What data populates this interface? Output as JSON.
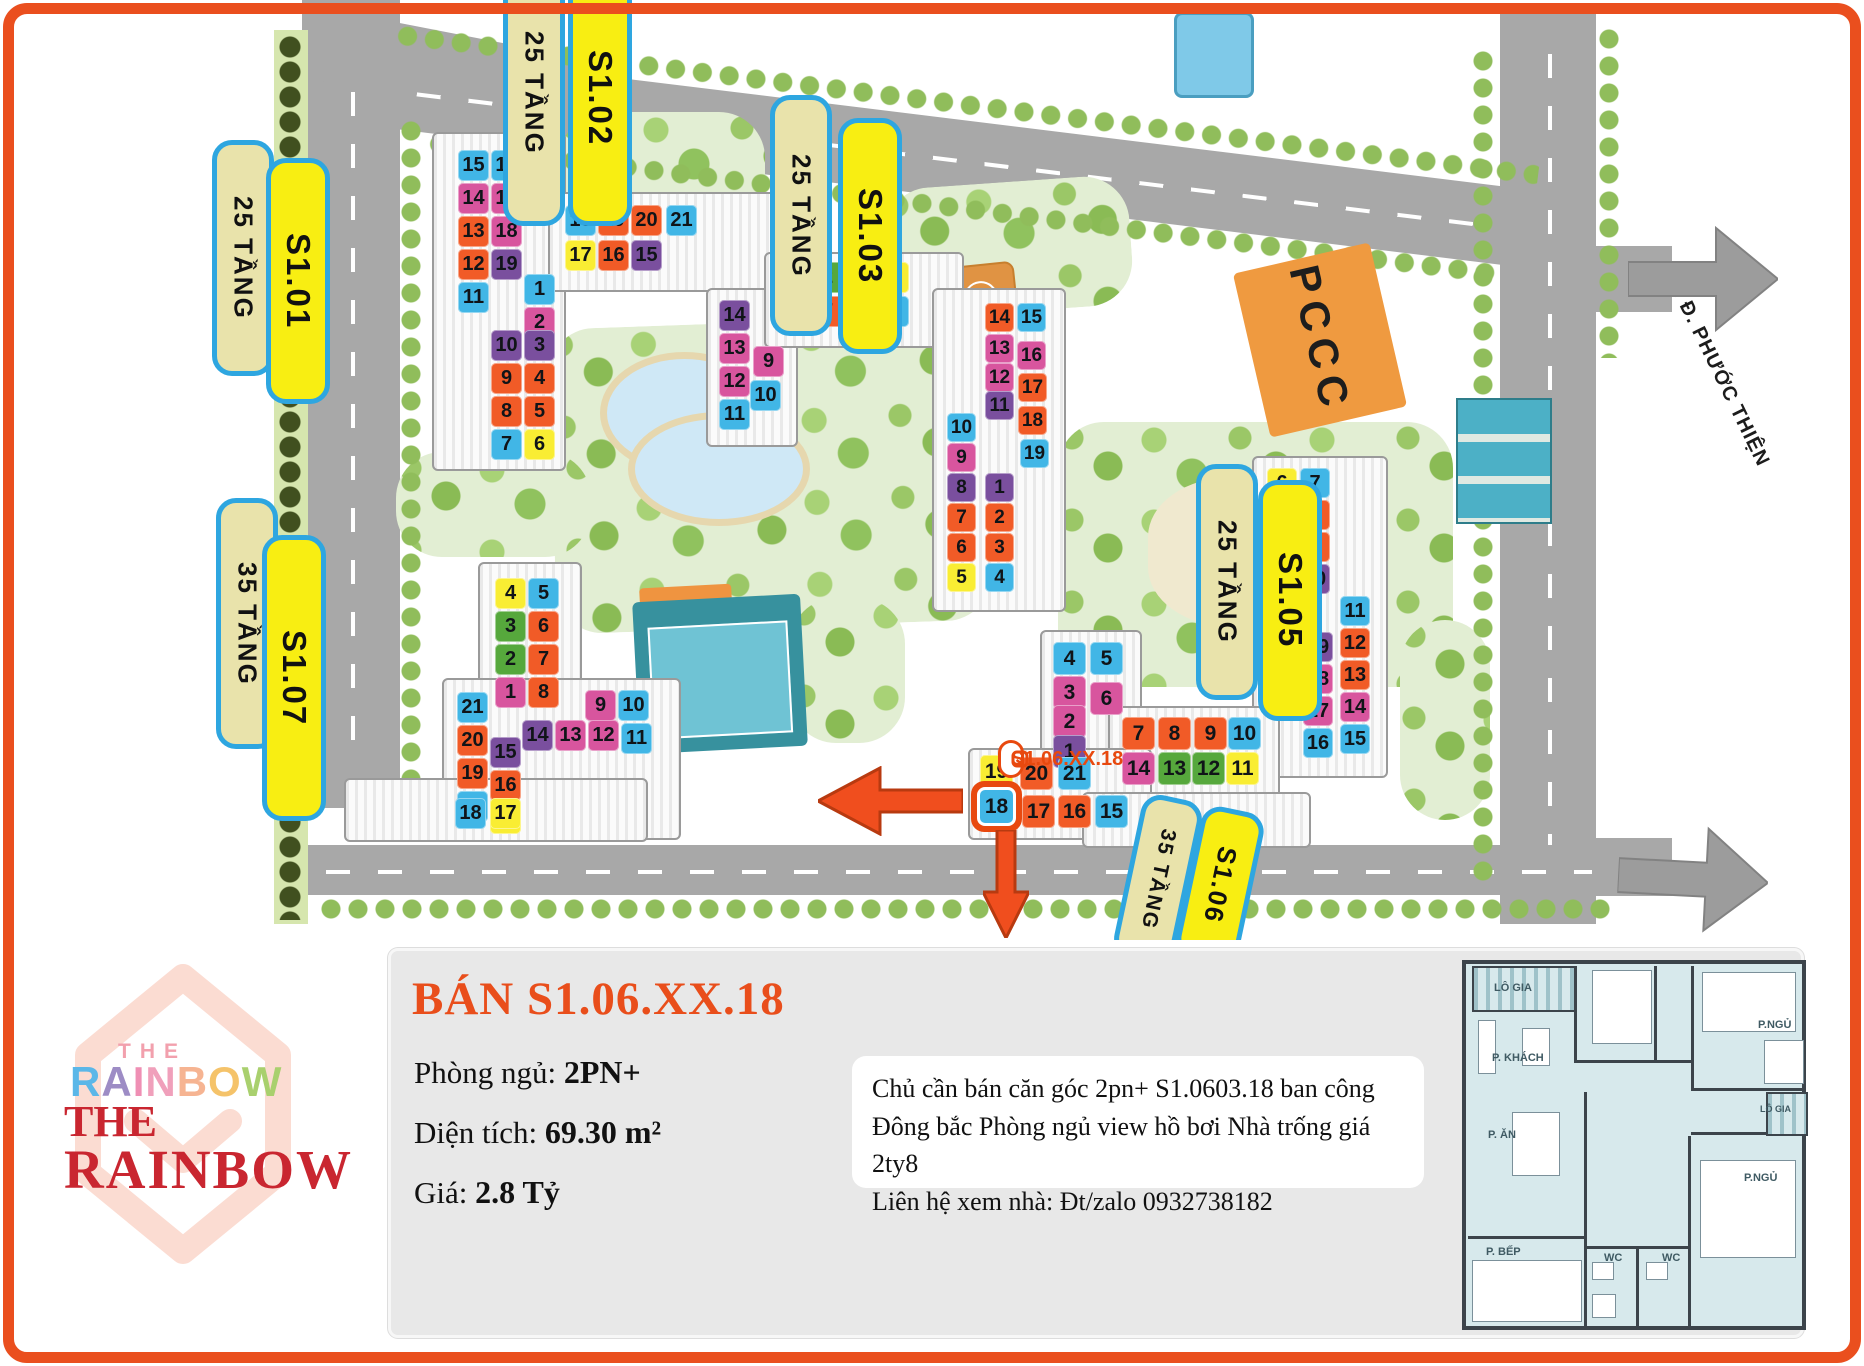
{
  "colors": {
    "accent": "#e94e1b",
    "pill_border": "#2ea6e0",
    "pill_yellow": "#f8ee12",
    "pill_khaki": "#e9e3ab",
    "tile_blue": "#41b6e6",
    "tile_orange": "#f15b27",
    "tile_pink": "#d8559e",
    "tile_purple": "#7a4f9e",
    "tile_yellow": "#f9ed33",
    "tile_green": "#56a83c"
  },
  "map": {
    "pccc_label": "PCCC",
    "road_sign": "ĐI Đ. PHƯỚC THIỆN",
    "marker": {
      "text": "S1.06.XX.18"
    },
    "pills": [
      {
        "id": "s101-floors",
        "kind": "floors",
        "text": "25 TẦNG",
        "x": 212,
        "y": 140,
        "h": 210
      },
      {
        "id": "s101-name",
        "kind": "name",
        "text": "S1.01",
        "x": 266,
        "y": 158,
        "h": 220
      },
      {
        "id": "s102-floors",
        "kind": "floors",
        "text": "25 TẦNG",
        "x": 503,
        "y": -40,
        "h": 240
      },
      {
        "id": "s102-name",
        "kind": "name",
        "text": "S1.02",
        "x": 568,
        "y": -30,
        "h": 230
      },
      {
        "id": "s103-floors",
        "kind": "floors",
        "text": "25 TẦNG",
        "x": 770,
        "y": 95,
        "h": 215
      },
      {
        "id": "s103-name",
        "kind": "name",
        "text": "S1.03",
        "x": 838,
        "y": 118,
        "h": 210
      },
      {
        "id": "s105-floors",
        "kind": "floors",
        "text": "25 TẦNG",
        "x": 1196,
        "y": 464,
        "h": 210
      },
      {
        "id": "s105-name",
        "kind": "name",
        "text": "S1.05",
        "x": 1258,
        "y": 480,
        "h": 215
      },
      {
        "id": "s107-floors",
        "kind": "floors",
        "text": "35 TẦNG",
        "x": 216,
        "y": 498,
        "h": 225
      },
      {
        "id": "s107-name",
        "kind": "name",
        "text": "S1.07",
        "x": 262,
        "y": 535,
        "h": 260
      },
      {
        "id": "s106-floors",
        "kind": "floors",
        "text": "35 TẦNG",
        "x": 1127,
        "y": 796,
        "h": 140,
        "fs": 21,
        "rot": 12
      },
      {
        "id": "s106-name",
        "kind": "name",
        "text": "S1.06",
        "x": 1188,
        "y": 808,
        "h": 128,
        "fs": 26,
        "rot": 12
      }
    ],
    "grids": [
      {
        "id": "s101",
        "size": 31,
        "tiles": [
          {
            "n": 15,
            "x": 458,
            "y": 150,
            "c": "blue"
          },
          {
            "n": 16,
            "x": 491,
            "y": 150,
            "c": "blue"
          },
          {
            "n": 14,
            "x": 458,
            "y": 183,
            "c": "pink"
          },
          {
            "n": 17,
            "x": 491,
            "y": 183,
            "c": "pink"
          },
          {
            "n": 13,
            "x": 458,
            "y": 216,
            "c": "orange"
          },
          {
            "n": 18,
            "x": 491,
            "y": 216,
            "c": "pink"
          },
          {
            "n": 12,
            "x": 458,
            "y": 249,
            "c": "orange"
          },
          {
            "n": 19,
            "x": 491,
            "y": 249,
            "c": "purple"
          },
          {
            "n": 11,
            "x": 458,
            "y": 282,
            "c": "blue"
          },
          {
            "n": 1,
            "x": 524,
            "y": 274,
            "c": "blue"
          },
          {
            "n": 2,
            "x": 524,
            "y": 307,
            "c": "pink"
          },
          {
            "n": 10,
            "x": 491,
            "y": 330,
            "c": "purple"
          },
          {
            "n": 3,
            "x": 524,
            "y": 330,
            "c": "purple"
          },
          {
            "n": 9,
            "x": 491,
            "y": 363,
            "c": "orange"
          },
          {
            "n": 4,
            "x": 524,
            "y": 363,
            "c": "orange"
          },
          {
            "n": 8,
            "x": 491,
            "y": 396,
            "c": "orange"
          },
          {
            "n": 5,
            "x": 524,
            "y": 396,
            "c": "orange"
          },
          {
            "n": 7,
            "x": 491,
            "y": 429,
            "c": "blue"
          },
          {
            "n": 6,
            "x": 524,
            "y": 429,
            "c": "yellow"
          }
        ]
      },
      {
        "id": "s102",
        "size": 31,
        "tiles": [
          {
            "n": 18,
            "x": 565,
            "y": 205,
            "c": "blue"
          },
          {
            "n": 19,
            "x": 598,
            "y": 205,
            "c": "orange"
          },
          {
            "n": 20,
            "x": 631,
            "y": 205,
            "c": "orange"
          },
          {
            "n": 21,
            "x": 666,
            "y": 205,
            "c": "blue"
          },
          {
            "n": 17,
            "x": 565,
            "y": 240,
            "c": "yellow"
          },
          {
            "n": 16,
            "x": 598,
            "y": 240,
            "c": "orange"
          },
          {
            "n": 15,
            "x": 631,
            "y": 240,
            "c": "purple"
          },
          {
            "n": 1,
            "x": 778,
            "y": 262,
            "c": "pink"
          },
          {
            "n": 2,
            "x": 812,
            "y": 262,
            "c": "green"
          },
          {
            "n": 3,
            "x": 845,
            "y": 262,
            "c": "green"
          },
          {
            "n": 4,
            "x": 878,
            "y": 262,
            "c": "yellow"
          },
          {
            "n": 8,
            "x": 778,
            "y": 296,
            "c": "orange"
          },
          {
            "n": 7,
            "x": 812,
            "y": 296,
            "c": "orange"
          },
          {
            "n": 6,
            "x": 845,
            "y": 296,
            "c": "orange"
          },
          {
            "n": 5,
            "x": 878,
            "y": 296,
            "c": "blue"
          },
          {
            "n": 14,
            "x": 719,
            "y": 300,
            "c": "purple"
          },
          {
            "n": 13,
            "x": 719,
            "y": 333,
            "c": "pink"
          },
          {
            "n": 9,
            "x": 753,
            "y": 346,
            "c": "pink"
          },
          {
            "n": 12,
            "x": 719,
            "y": 366,
            "c": "pink"
          },
          {
            "n": 10,
            "x": 750,
            "y": 380,
            "c": "blue"
          },
          {
            "n": 11,
            "x": 719,
            "y": 399,
            "c": "blue"
          }
        ]
      },
      {
        "id": "s103",
        "size": 29,
        "tiles": [
          {
            "n": 14,
            "x": 985,
            "y": 303,
            "c": "orange"
          },
          {
            "n": 15,
            "x": 1017,
            "y": 303,
            "c": "blue"
          },
          {
            "n": 13,
            "x": 985,
            "y": 334,
            "c": "pink"
          },
          {
            "n": 16,
            "x": 1017,
            "y": 341,
            "c": "pink"
          },
          {
            "n": 12,
            "x": 985,
            "y": 363,
            "c": "pink"
          },
          {
            "n": 17,
            "x": 1018,
            "y": 373,
            "c": "orange"
          },
          {
            "n": 11,
            "x": 985,
            "y": 391,
            "c": "purple"
          },
          {
            "n": 18,
            "x": 1018,
            "y": 406,
            "c": "orange"
          },
          {
            "n": 19,
            "x": 1020,
            "y": 439,
            "c": "blue"
          },
          {
            "n": 10,
            "x": 947,
            "y": 413,
            "c": "blue"
          },
          {
            "n": 9,
            "x": 947,
            "y": 443,
            "c": "pink"
          },
          {
            "n": 8,
            "x": 947,
            "y": 473,
            "c": "purple"
          },
          {
            "n": 1,
            "x": 985,
            "y": 473,
            "c": "purple"
          },
          {
            "n": 7,
            "x": 947,
            "y": 503,
            "c": "orange"
          },
          {
            "n": 2,
            "x": 985,
            "y": 503,
            "c": "orange"
          },
          {
            "n": 6,
            "x": 947,
            "y": 533,
            "c": "orange"
          },
          {
            "n": 3,
            "x": 985,
            "y": 533,
            "c": "orange"
          },
          {
            "n": 5,
            "x": 947,
            "y": 563,
            "c": "yellow"
          },
          {
            "n": 4,
            "x": 985,
            "y": 563,
            "c": "blue"
          }
        ]
      },
      {
        "id": "s105",
        "size": 30,
        "tiles": [
          {
            "n": 6,
            "x": 1267,
            "y": 468,
            "c": "yellow"
          },
          {
            "n": 7,
            "x": 1300,
            "y": 468,
            "c": "blue"
          },
          {
            "n": 5,
            "x": 1267,
            "y": 500,
            "c": "orange"
          },
          {
            "n": 8,
            "x": 1300,
            "y": 500,
            "c": "orange"
          },
          {
            "n": 4,
            "x": 1267,
            "y": 532,
            "c": "orange"
          },
          {
            "n": 9,
            "x": 1300,
            "y": 532,
            "c": "orange"
          },
          {
            "n": 3,
            "x": 1267,
            "y": 564,
            "c": "purple"
          },
          {
            "n": 10,
            "x": 1300,
            "y": 564,
            "c": "purple"
          },
          {
            "n": 2,
            "x": 1267,
            "y": 596,
            "c": "pink"
          },
          {
            "n": 11,
            "x": 1340,
            "y": 596,
            "c": "blue"
          },
          {
            "n": 1,
            "x": 1267,
            "y": 628,
            "c": "blue"
          },
          {
            "n": 19,
            "x": 1303,
            "y": 632,
            "c": "purple"
          },
          {
            "n": 12,
            "x": 1340,
            "y": 628,
            "c": "orange"
          },
          {
            "n": 18,
            "x": 1303,
            "y": 664,
            "c": "pink"
          },
          {
            "n": 13,
            "x": 1340,
            "y": 660,
            "c": "orange"
          },
          {
            "n": 17,
            "x": 1303,
            "y": 696,
            "c": "pink"
          },
          {
            "n": 14,
            "x": 1340,
            "y": 692,
            "c": "pink"
          },
          {
            "n": 16,
            "x": 1303,
            "y": 728,
            "c": "blue"
          },
          {
            "n": 15,
            "x": 1340,
            "y": 724,
            "c": "blue"
          }
        ]
      },
      {
        "id": "s107",
        "size": 31,
        "tiles": [
          {
            "n": 4,
            "x": 495,
            "y": 578,
            "c": "yellow"
          },
          {
            "n": 5,
            "x": 528,
            "y": 578,
            "c": "blue"
          },
          {
            "n": 3,
            "x": 495,
            "y": 611,
            "c": "green"
          },
          {
            "n": 6,
            "x": 528,
            "y": 611,
            "c": "orange"
          },
          {
            "n": 2,
            "x": 495,
            "y": 644,
            "c": "green"
          },
          {
            "n": 7,
            "x": 528,
            "y": 644,
            "c": "orange"
          },
          {
            "n": 1,
            "x": 495,
            "y": 677,
            "c": "pink"
          },
          {
            "n": 8,
            "x": 528,
            "y": 677,
            "c": "orange"
          },
          {
            "n": 21,
            "x": 457,
            "y": 692,
            "c": "blue"
          },
          {
            "n": 9,
            "x": 585,
            "y": 690,
            "c": "pink"
          },
          {
            "n": 10,
            "x": 618,
            "y": 690,
            "c": "blue"
          },
          {
            "n": 20,
            "x": 457,
            "y": 725,
            "c": "orange"
          },
          {
            "n": 14,
            "x": 522,
            "y": 720,
            "c": "purple"
          },
          {
            "n": 13,
            "x": 555,
            "y": 720,
            "c": "pink"
          },
          {
            "n": 12,
            "x": 588,
            "y": 720,
            "c": "pink"
          },
          {
            "n": 11,
            "x": 621,
            "y": 723,
            "c": "blue"
          },
          {
            "n": 15,
            "x": 490,
            "y": 737,
            "c": "purple"
          },
          {
            "n": 19,
            "x": 457,
            "y": 758,
            "c": "orange"
          },
          {
            "n": 16,
            "x": 490,
            "y": 770,
            "c": "orange"
          },
          {
            "n": 18,
            "x": 457,
            "y": 791,
            "c": "blue"
          },
          {
            "n": 17,
            "x": 490,
            "y": 803,
            "c": "yellow"
          }
        ]
      },
      {
        "id": "s106",
        "size": 33,
        "tiles": [
          {
            "n": 4,
            "x": 1053,
            "y": 642,
            "c": "blue"
          },
          {
            "n": 5,
            "x": 1090,
            "y": 642,
            "c": "blue"
          },
          {
            "n": 3,
            "x": 1053,
            "y": 676,
            "c": "pink"
          },
          {
            "n": 6,
            "x": 1090,
            "y": 682,
            "c": "pink"
          },
          {
            "n": 2,
            "x": 1053,
            "y": 705,
            "c": "pink"
          },
          {
            "n": 1,
            "x": 1053,
            "y": 735,
            "c": "purple"
          },
          {
            "n": 7,
            "x": 1122,
            "y": 717,
            "c": "orange"
          },
          {
            "n": 8,
            "x": 1158,
            "y": 717,
            "c": "orange"
          },
          {
            "n": 9,
            "x": 1194,
            "y": 717,
            "c": "orange"
          },
          {
            "n": 10,
            "x": 1228,
            "y": 717,
            "c": "blue"
          },
          {
            "n": 14,
            "x": 1122,
            "y": 752,
            "c": "pink"
          },
          {
            "n": 13,
            "x": 1158,
            "y": 752,
            "c": "green"
          },
          {
            "n": 12,
            "x": 1192,
            "y": 752,
            "c": "green"
          },
          {
            "n": 11,
            "x": 1226,
            "y": 752,
            "c": "yellow"
          },
          {
            "n": 19,
            "x": 980,
            "y": 755,
            "c": "yellow"
          },
          {
            "n": 20,
            "x": 1020,
            "y": 757,
            "c": "orange"
          },
          {
            "n": 21,
            "x": 1058,
            "y": 757,
            "c": "blue"
          },
          {
            "n": 18,
            "x": 980,
            "y": 790,
            "c": "blue",
            "hl": true
          },
          {
            "n": 17,
            "x": 1022,
            "y": 795,
            "c": "orange"
          },
          {
            "n": 16,
            "x": 1058,
            "y": 795,
            "c": "orange"
          },
          {
            "n": 15,
            "x": 1095,
            "y": 795,
            "c": "blue"
          }
        ]
      },
      {
        "id": "s1-bottom",
        "size": 31,
        "tiles": [
          {
            "n": 18,
            "x": 455,
            "y": 798,
            "c": "blue"
          },
          {
            "n": 17,
            "x": 490,
            "y": 798,
            "c": "yellow"
          }
        ]
      }
    ]
  },
  "panel": {
    "title": "BÁN S1.06.XX.18",
    "specs": [
      {
        "label": "Phòng ngủ:",
        "value": "2PN+"
      },
      {
        "label": "Diện tích:",
        "value": "69.30 m²"
      },
      {
        "label": "Giá:",
        "value": "2.8 Tỷ"
      }
    ],
    "note": {
      "lines": [
        "Chủ cần bán căn góc 2pn+ S1.0603.18 ban công",
        "Đông bắc Phòng ngủ view hồ bơi Nhà trống giá 2ty8",
        "Liên hệ xem nhà: Đt/zalo 0932738182"
      ]
    }
  },
  "logo": {
    "the_small": "THE",
    "rainbow_letters": [
      {
        "ch": "R",
        "color": "#5bb7e8"
      },
      {
        "ch": "A",
        "color": "#9d8cc5"
      },
      {
        "ch": "I",
        "color": "#ef8fb4"
      },
      {
        "ch": "N",
        "color": "#f0a0bb"
      },
      {
        "ch": "B",
        "color": "#f6b492"
      },
      {
        "ch": "O",
        "color": "#f5c36a"
      },
      {
        "ch": "W",
        "color": "#a9d06e"
      }
    ],
    "the_big": "THE",
    "rainbow_big": "RAINBOW"
  },
  "floorplan": {
    "labels": [
      {
        "t": "LÔ GIA",
        "x": 28,
        "y": 18
      },
      {
        "t": "P.NGỦ",
        "x": 292,
        "y": 55
      },
      {
        "t": "P. KHÁCH",
        "x": 26,
        "y": 88
      },
      {
        "t": "LÔ GIA",
        "x": 294,
        "y": 140,
        "fs": 9
      },
      {
        "t": "P. ĂN",
        "x": 22,
        "y": 165
      },
      {
        "t": "P.NGỦ",
        "x": 278,
        "y": 208
      },
      {
        "t": "P. BẾP",
        "x": 20,
        "y": 282
      },
      {
        "t": "WC",
        "x": 138,
        "y": 288
      },
      {
        "t": "WC",
        "x": 196,
        "y": 288
      }
    ]
  }
}
